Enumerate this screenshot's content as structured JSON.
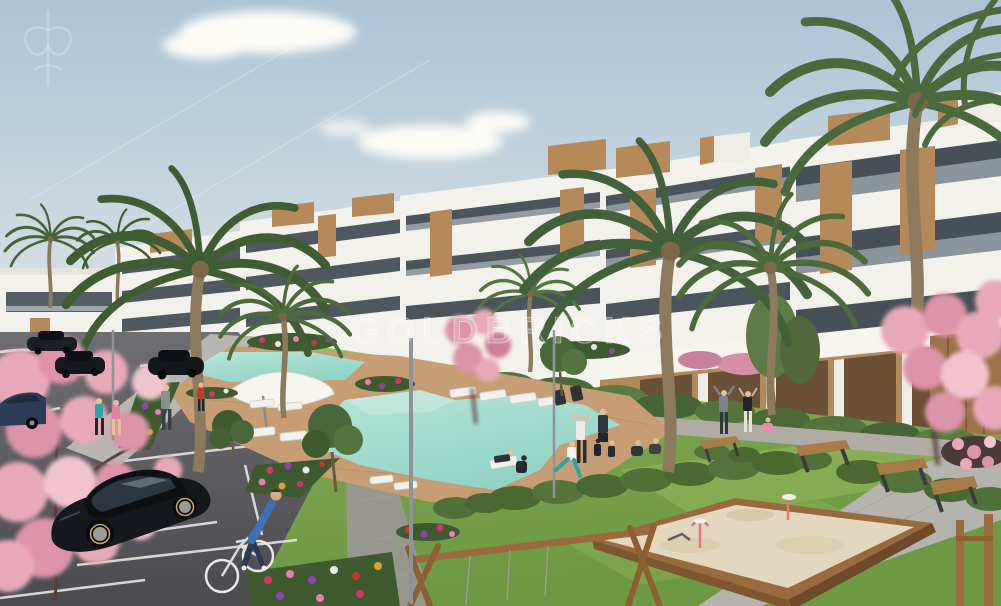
{
  "watermark": {
    "text": "GOLDBRICKS",
    "emblem_icon": "fleur-crest-icon"
  },
  "palette": {
    "sky_top": "#aac4d6",
    "sky_bottom": "#dde3e6",
    "building_white": "#f3f1ec",
    "window_dark": "#39434c",
    "wood_accent": "#b68a58",
    "lawn": "#79a24c",
    "lawn_light": "#a9c468",
    "hedge": "#4a6830",
    "pool_water": "#8fd2c4",
    "deck_wood": "#c79e74",
    "path_grey": "#b7b6b2",
    "asphalt": "#5f5f63",
    "blossom_pink": "#e7a9ba",
    "sand": "#e3d7bd",
    "bench_wood": "#a87c46",
    "car_black": "#15181c",
    "car_blue": "#2c3c58",
    "palm_green": "#3f5c33"
  }
}
